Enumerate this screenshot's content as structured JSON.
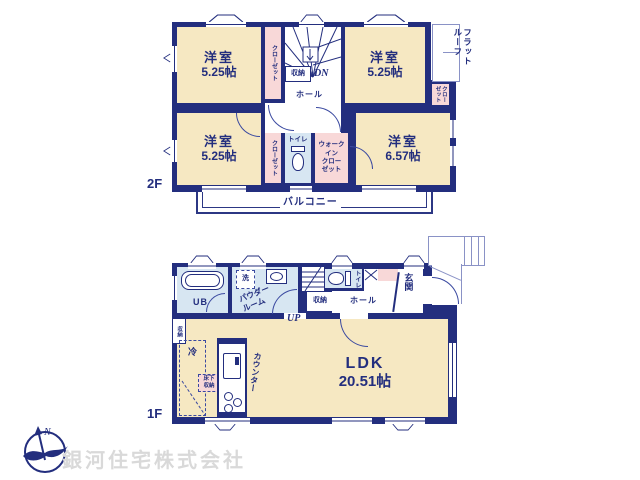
{
  "colors": {
    "wall": "#232e7e",
    "room_fill": "#f6e8c2",
    "closet_fill": "#f8d8d8",
    "wet_area_fill": "#d7e6f2",
    "thin_line": "#8a92c6",
    "logo_text": "#d9d9d9"
  },
  "f2": {
    "label": "2F",
    "room_a": {
      "name": "洋室",
      "size": "5.25帖"
    },
    "room_b": {
      "name": "洋室",
      "size": "5.25帖"
    },
    "room_c": {
      "name": "洋室",
      "size": "5.25帖"
    },
    "room_d": {
      "name": "洋室",
      "size": "6.57帖"
    },
    "closet_a": "クローゼット",
    "closet_b": "クロー\nゼット",
    "closet_c": "クローゼット",
    "wic": "ウォーク\nイン\nクロー\nゼット",
    "toilet": "トイレ",
    "storage": "収納",
    "hall": "ホール",
    "dn": "DN",
    "balcony": "バルコニー",
    "flat_roof": "フラット\nルーフ"
  },
  "f1": {
    "label": "1F",
    "ub": "UB",
    "wash": "洗",
    "powder": "パウダー\nルーム",
    "up": "UP",
    "storage": "収納",
    "toilet": "トイレ",
    "hall": "ホール",
    "genkan": "玄関",
    "ldk": {
      "name": "LDK",
      "size": "20.51帖"
    },
    "side_storage": "収納",
    "fridge": "冷",
    "underfloor": "床下\n収納",
    "counter": "カウンター"
  },
  "company": {
    "name": "銀河住宅株式会社",
    "north": "N"
  }
}
